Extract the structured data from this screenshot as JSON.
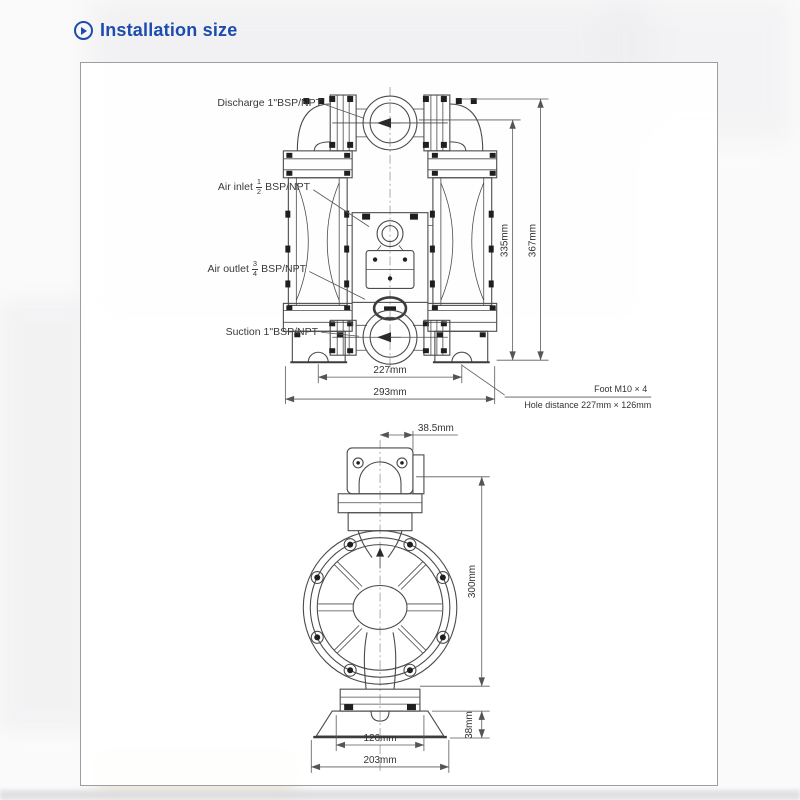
{
  "header": {
    "title": "Installation size"
  },
  "panel": {
    "front_view": {
      "ports": {
        "discharge": "Discharge 1\"BSP/NPT",
        "air_inlet": {
          "prefix": "Air inlet",
          "num": "1",
          "den": "2",
          "suffix": "BSP/NPT"
        },
        "air_outlet": {
          "prefix": "Air outlet",
          "num": "3",
          "den": "4",
          "suffix": "BSP/NPT"
        },
        "suction": "Suction 1\"BSP/NPT"
      },
      "dims": {
        "inner_height": "335mm",
        "outer_height": "367mm",
        "inner_width": "227mm",
        "outer_width": "293mm"
      },
      "notes": {
        "foot": "Foot M10 × 4",
        "hole_distance": "Hole distance 227mm × 126mm"
      }
    },
    "side_view": {
      "dims": {
        "top_offset": "38.5mm",
        "body_height": "300mm",
        "foot_height": "38mm",
        "bolt_span": "126mm",
        "base_width": "203mm"
      }
    }
  }
}
